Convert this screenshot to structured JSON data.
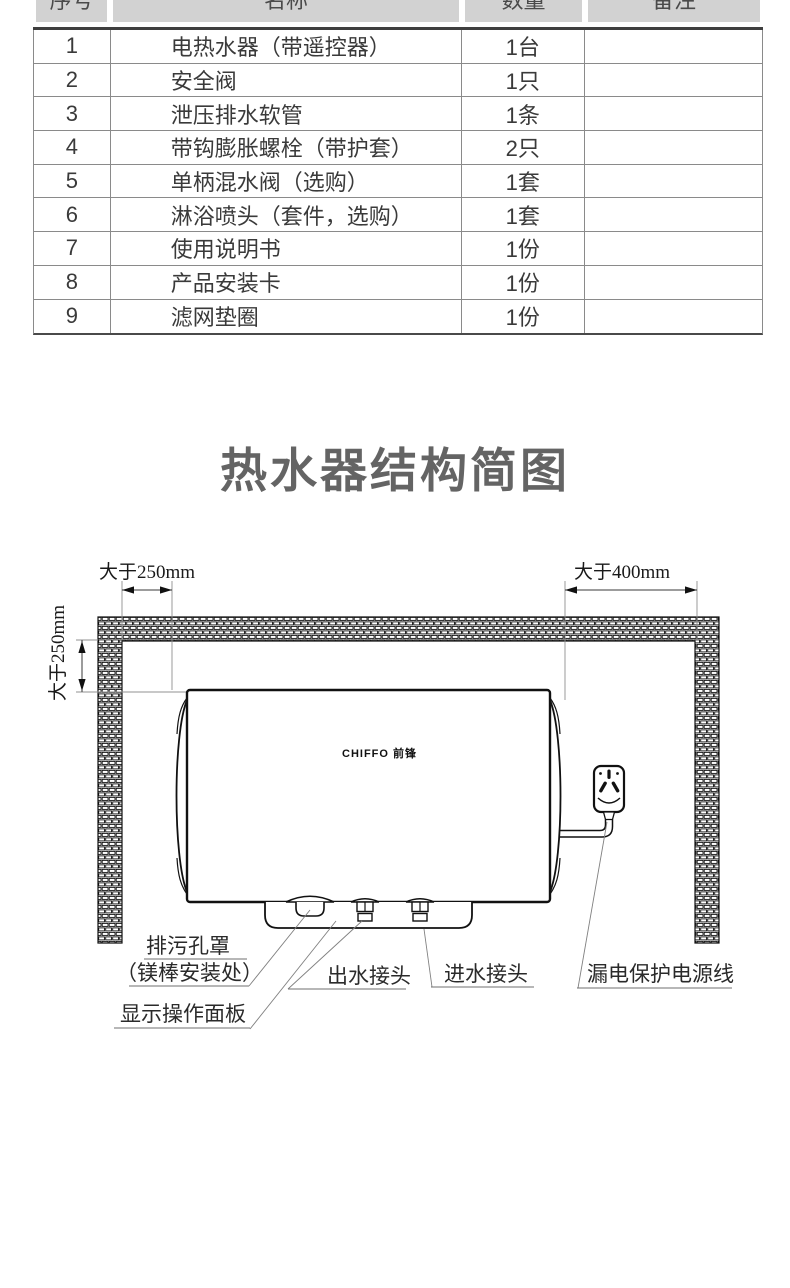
{
  "table": {
    "headers": [
      "序号",
      "名称",
      "数量",
      "备注"
    ],
    "rows": [
      {
        "no": "1",
        "name": "电热水器（带遥控器）",
        "qty": "1台",
        "note": ""
      },
      {
        "no": "2",
        "name": "安全阀",
        "qty": "1只",
        "note": ""
      },
      {
        "no": "3",
        "name": "泄压排水软管",
        "qty": "1条",
        "note": ""
      },
      {
        "no": "4",
        "name": "带钩膨胀螺栓（带护套）",
        "qty": "2只",
        "note": ""
      },
      {
        "no": "5",
        "name": "单柄混水阀（选购）",
        "qty": "1套",
        "note": ""
      },
      {
        "no": "6",
        "name": "淋浴喷头（套件，选购）",
        "qty": "1套",
        "note": ""
      },
      {
        "no": "7",
        "name": "使用说明书",
        "qty": "1份",
        "note": ""
      },
      {
        "no": "8",
        "name": "产品安装卡",
        "qty": "1份",
        "note": ""
      },
      {
        "no": "9",
        "name": "滤网垫圈",
        "qty": "1份",
        "note": ""
      }
    ]
  },
  "title": "热水器结构简图",
  "diagram": {
    "dim_top_left": "大于250mm",
    "dim_left_vertical": "大于250mm",
    "dim_top_right": "大于400mm",
    "brand_logo": "CHIFFO 前锋",
    "label_drain_line1": "排污孔罩",
    "label_drain_line2": "（镁棒安装处）",
    "label_display_panel": "显示操作面板",
    "label_outlet": "出水接头",
    "label_inlet": "进水接头",
    "label_power_cord": "漏电保护电源线"
  },
  "colors": {
    "header_bg": "#d2d2d2",
    "line": "#111111",
    "title": "#646464",
    "text": "#3a3a3a"
  }
}
